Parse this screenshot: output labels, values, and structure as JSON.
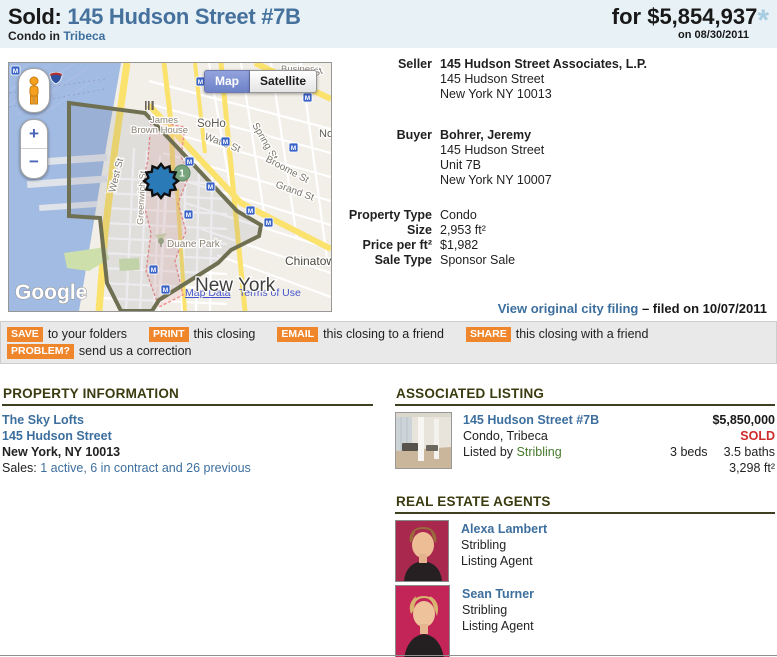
{
  "header": {
    "sold_label": "Sold:",
    "address": "145 Hudson Street #7B",
    "price_prefix": "for",
    "price": "$5,854,937",
    "footnote_mark": "*",
    "sale_date": "on 08/30/2011",
    "subtitle_prefix": "Condo in",
    "neighborhood": "Tribeca"
  },
  "map": {
    "controls": {
      "map": "Map",
      "satellite": "Satellite",
      "zoom_in": "+",
      "zoom_out": "−"
    },
    "attribution": {
      "logo": "Google",
      "map_data": "Map Data",
      "terms": "Terms of Use"
    },
    "labels": {
      "city": "New York",
      "business": "Business",
      "soho": "SoHo",
      "james": "James",
      "brown_house": "Brown House",
      "watts": "Watts St",
      "spring": "Spring St",
      "broome": "Broome St",
      "grand": "Grand St",
      "houston": "Houston St",
      "west": "West St",
      "greenwich": "Greenwich St",
      "duane_park": "Duane Park",
      "chinatown": "Chinatown",
      "nolita": "Nolita",
      "subway": "M",
      "transit_line": "1"
    }
  },
  "deed": {
    "seller": {
      "label": "Seller",
      "name": "145 Hudson Street Associates, L.P.",
      "address_lines": [
        "145 Hudson Street",
        "New York NY 10013"
      ]
    },
    "buyer": {
      "label": "Buyer",
      "name": "Bohrer, Jeremy",
      "address_lines": [
        "145 Hudson Street",
        "Unit 7B",
        "New York NY 10007"
      ]
    },
    "details": [
      {
        "label": "Property Type",
        "value": "Condo"
      },
      {
        "label": "Size",
        "value": "2,953 ft²"
      },
      {
        "label": "Price per ft²",
        "value": "$1,982"
      },
      {
        "label": "Sale Type",
        "value": "Sponsor Sale"
      }
    ],
    "filing_link": "View original city filing",
    "filing_note": "– filed on 10/07/2011"
  },
  "toolbar": {
    "actions": [
      {
        "button": "SAVE",
        "text": "to your folders"
      },
      {
        "button": "PRINT",
        "text": "this closing"
      },
      {
        "button": "EMAIL",
        "text": "this closing to a friend"
      },
      {
        "button": "SHARE",
        "text": "this closing with a friend"
      }
    ],
    "problem": {
      "button": "PROBLEM?",
      "text": "send us a correction"
    }
  },
  "property_info": {
    "heading": "PROPERTY INFORMATION",
    "building_link": "The Sky Lofts",
    "address_link": "145 Hudson Street",
    "city_line": "New York, NY 10013",
    "sales_label": "Sales:",
    "sales_link": "1 active, 6 in contract and 26 previous"
  },
  "associated_listing": {
    "heading": "ASSOCIATED LISTING",
    "address_link": "145 Hudson Street #7B",
    "type_line": "Condo, Tribeca",
    "listed_by": "Listed by",
    "broker_link": "Stribling",
    "price": "$5,850,000",
    "status": "SOLD",
    "beds": "3 beds",
    "baths": "3.5 baths",
    "size": "3,298 ft²"
  },
  "agents": {
    "heading": "REAL ESTATE AGENTS",
    "list": [
      {
        "name": "Alexa Lambert",
        "company": "Stribling",
        "role": "Listing Agent"
      },
      {
        "name": "Sean Turner",
        "company": "Stribling",
        "role": "Listing Agent"
      }
    ]
  },
  "colors": {
    "accent_orange": "#f0862c",
    "link_blue": "#3d6f9e",
    "sold_red": "#ce2b2b",
    "broker_green": "#467b2c",
    "header_bg": "#e7f1f6"
  }
}
